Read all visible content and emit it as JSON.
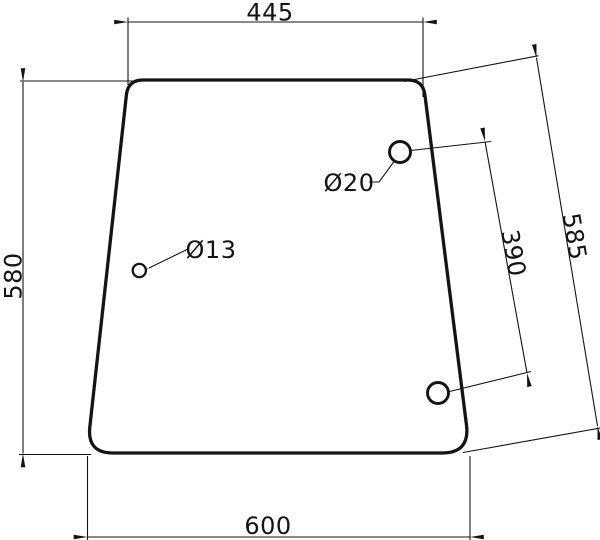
{
  "drawing": {
    "labels": {
      "dim_top_width": "445",
      "dim_left_height": "580",
      "dim_right_edge": "585",
      "dim_hole_spacing": "390",
      "dim_bottom_width": "600",
      "hole_small": "Ø13",
      "hole_large": "Ø20"
    },
    "colors": {
      "line": "#141414",
      "background": "#ffffff"
    }
  }
}
